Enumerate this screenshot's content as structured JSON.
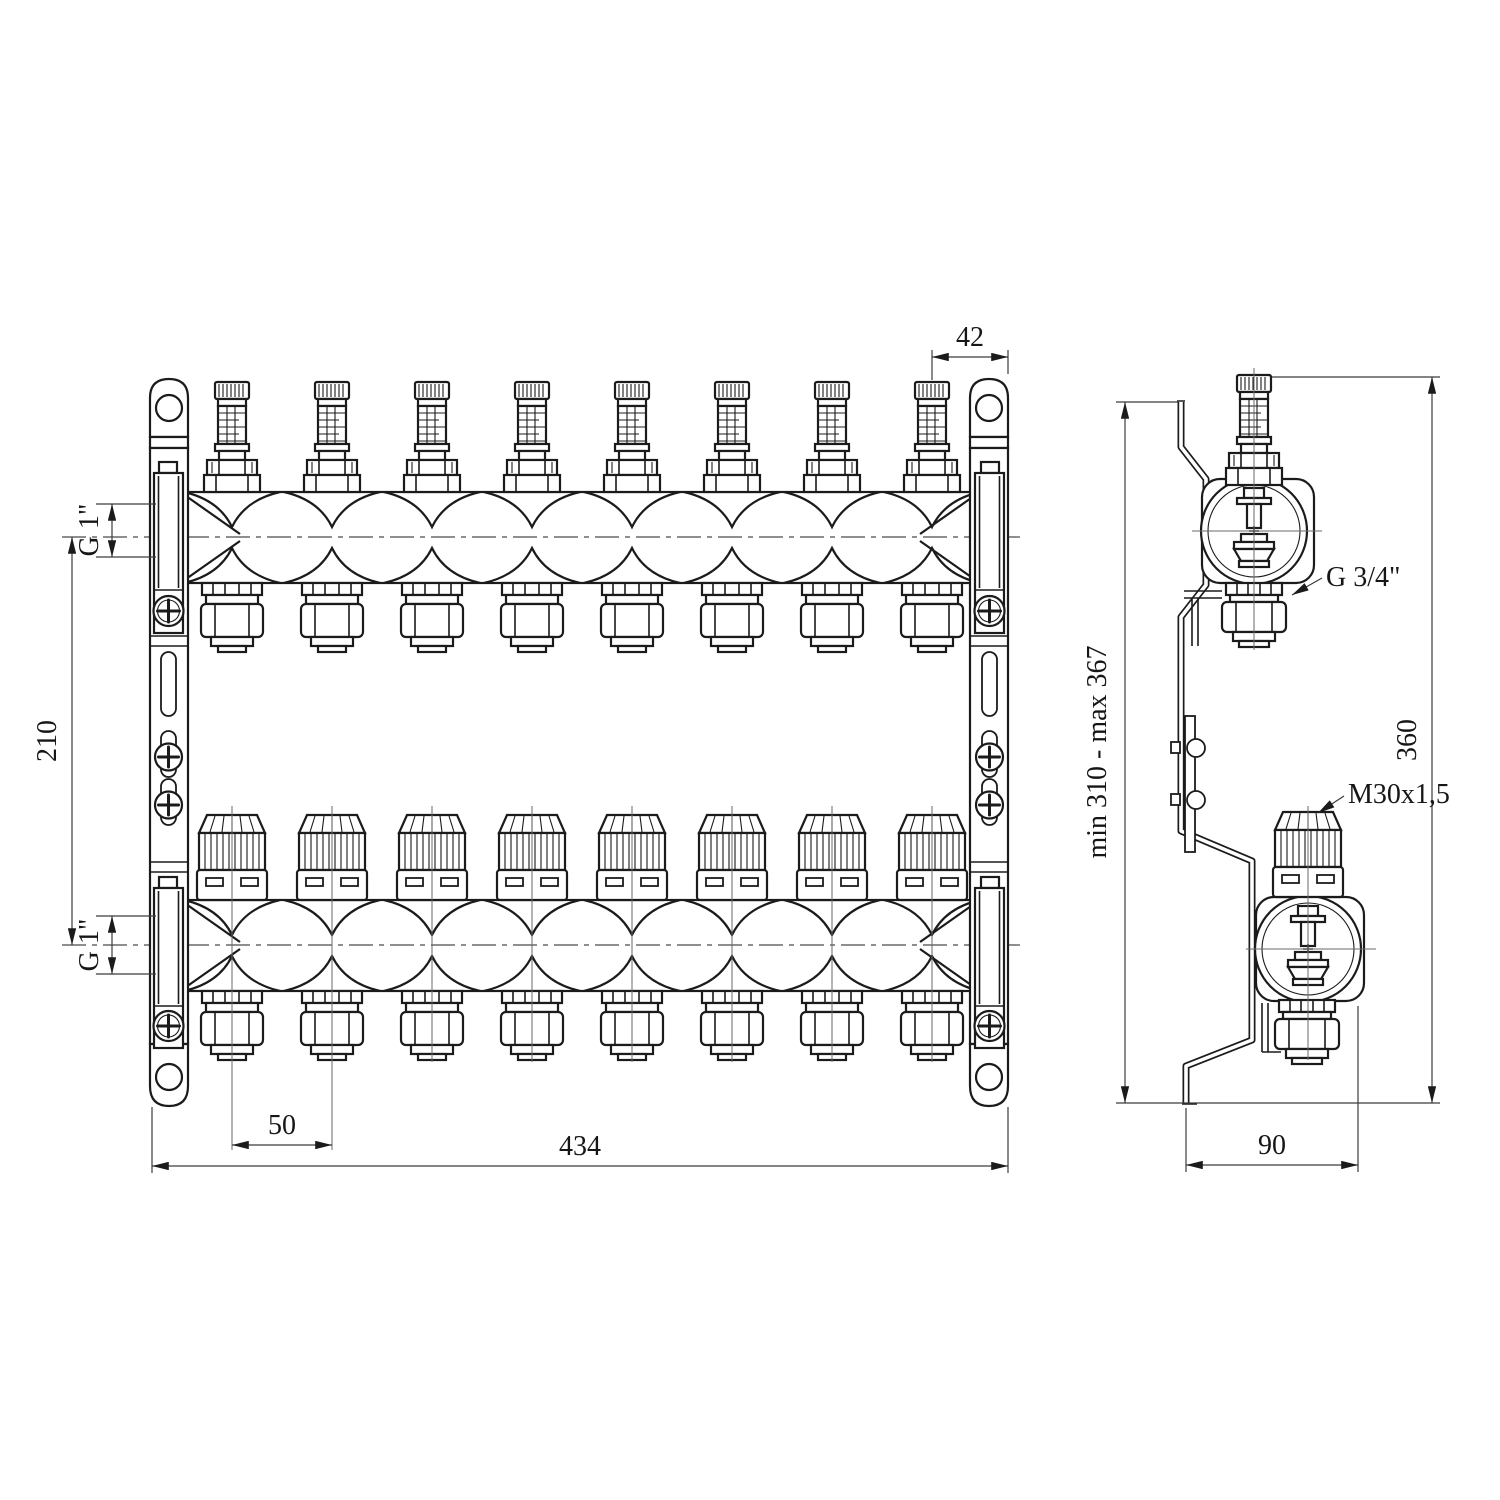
{
  "front_view": {
    "ports": 8,
    "dimensions": {
      "offset_42": "42",
      "supply_connection": "G 1\"",
      "center_distance": "210",
      "return_connection": "G 1\"",
      "port_spacing": "50",
      "total_width": "434"
    }
  },
  "side_view": {
    "dimensions": {
      "mount_height_range": "min 310 - max 367",
      "total_height": "360",
      "depth": "90"
    },
    "labels": {
      "outlet_thread": "G 3/4\"",
      "valve_thread": "M30x1,5"
    }
  },
  "colors": {
    "line": "#1b1b1b",
    "dimension": "#3c3c3c",
    "background": "#ffffff"
  }
}
